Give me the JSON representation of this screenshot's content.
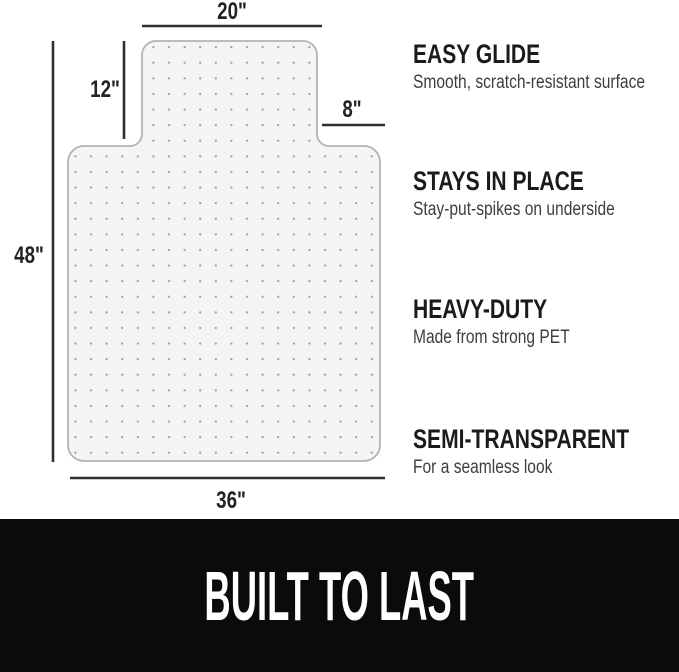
{
  "colors": {
    "mat_fill": "#f4f4f2",
    "mat_border": "#b3b3b0",
    "dot_color": "#9c9c99",
    "dimension_color": "#2f2f2f",
    "banner_background": "#0b0b0b",
    "banner_text_color": "#ffffff",
    "heading_color": "#1b1b1b",
    "subtext_color": "#3e3e3e"
  },
  "diagram": {
    "description": "dimensioned drawing of a T-shaped office chair mat with lip, studded with small grip dots",
    "dimensions": {
      "lip_width": "20\"",
      "lip_height": "12\"",
      "right_offset": "8\"",
      "mat_height": "48\"",
      "mat_width": "36\""
    }
  },
  "features": [
    {
      "title": "EASY GLIDE",
      "description": "Smooth, scratch-resistant surface"
    },
    {
      "title": "STAYS IN PLACE",
      "description": "Stay-put-spikes on underside"
    },
    {
      "title": "HEAVY-DUTY",
      "description": "Made from strong PET"
    },
    {
      "title": "SEMI-TRANSPARENT",
      "description": "For a seamless look"
    }
  ],
  "banner": {
    "text": "BUILT TO LAST"
  }
}
